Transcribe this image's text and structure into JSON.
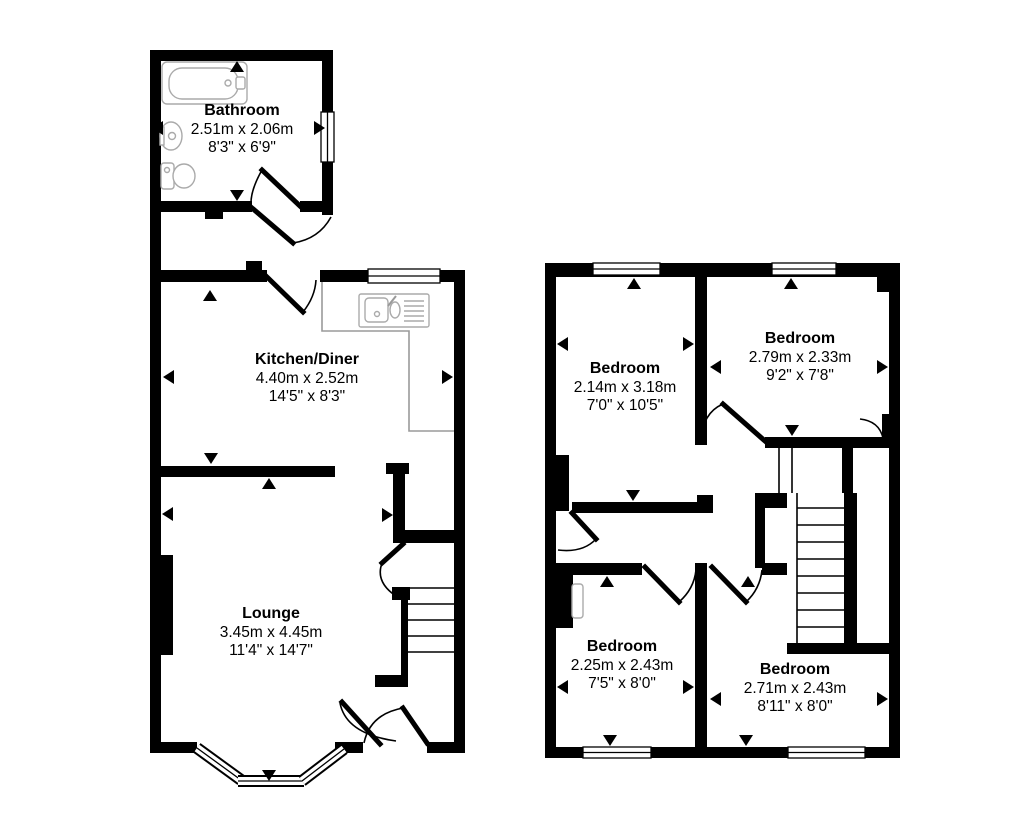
{
  "floorplan": {
    "colors": {
      "wall": "#000000",
      "background": "#ffffff",
      "fixture_outline": "#999999",
      "text": "#000000"
    },
    "ground_floor": {
      "rooms": [
        {
          "key": "bathroom",
          "name": "Bathroom",
          "metric": "2.51m x 2.06m",
          "imperial": "8'3\" x 6'9\""
        },
        {
          "key": "kitchen-diner",
          "name": "Kitchen/Diner",
          "metric": "4.40m x 2.52m",
          "imperial": "14'5\" x 8'3\""
        },
        {
          "key": "lounge",
          "name": "Lounge",
          "metric": "3.45m x 4.45m",
          "imperial": "11'4\" x 14'7\""
        }
      ]
    },
    "first_floor": {
      "rooms": [
        {
          "key": "bedroom-front-left",
          "name": "Bedroom",
          "metric": "2.14m x 3.18m",
          "imperial": "7'0\" x 10'5\""
        },
        {
          "key": "bedroom-front-right",
          "name": "Bedroom",
          "metric": "2.79m x 2.33m",
          "imperial": "9'2\" x 7'8\""
        },
        {
          "key": "bedroom-back-left",
          "name": "Bedroom",
          "metric": "2.25m x 2.43m",
          "imperial": "7'5\" x 8'0\""
        },
        {
          "key": "bedroom-back-right",
          "name": "Bedroom",
          "metric": "2.71m x 2.43m",
          "imperial": "8'11\" x 8'0\""
        }
      ]
    }
  }
}
